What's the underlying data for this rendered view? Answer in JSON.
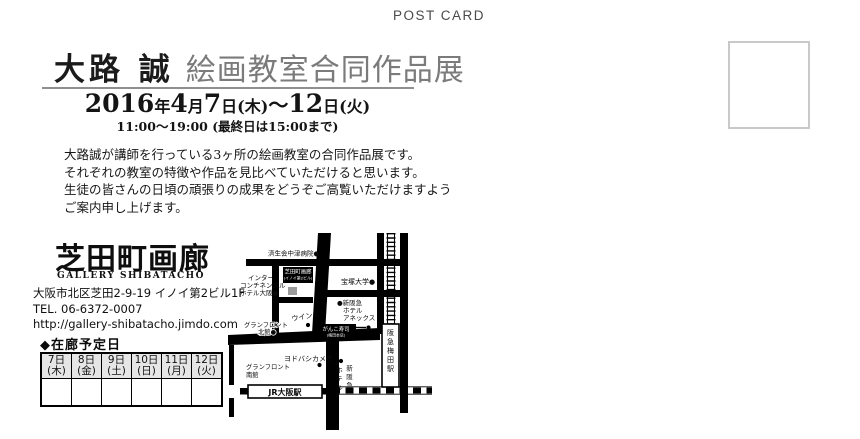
{
  "postcard_label": "POST CARD",
  "header": {
    "artist": "大路 誠",
    "exhibition": "絵画教室合同作品展",
    "date": {
      "year": "2016",
      "year_unit": "年",
      "month": "4",
      "month_unit": "月",
      "day_start": "7",
      "day_start_week": "日(木)",
      "tilde": "～",
      "day_end": "12",
      "day_end_week": "日(火)"
    },
    "time": "11:00～19:00 (最終日は15:00まで)"
  },
  "intro": {
    "lines": [
      "大路誠が講師を行っている3ヶ所の絵画教室の合同作品展です。",
      "それぞれの教室の特徴や作品を見比べていただけると思います。",
      "生徒の皆さんの日頃の頑張りの成果をどうぞご高覧いただけますよう",
      "ご案内申し上げます。"
    ]
  },
  "gallery": {
    "logo": "芝田町画廊",
    "logo_sub": "GALLERY SHIBATACHO",
    "address": "大阪市北区芝田2-9-19 イノイ第2ビル1F",
    "tel": "TEL. 06-6372-0007",
    "url": "http://gallery-shibatacho.jimdo.com"
  },
  "schedule": {
    "title": "◆在廊予定日",
    "days": [
      {
        "date": "7日",
        "weekday": "(木)"
      },
      {
        "date": "8日",
        "weekday": "(金)"
      },
      {
        "date": "9日",
        "weekday": "(土)"
      },
      {
        "date": "10日",
        "weekday": "(日)"
      },
      {
        "date": "11日",
        "weekday": "(月)"
      },
      {
        "date": "12日",
        "weekday": "(火)"
      }
    ]
  },
  "map": {
    "hospital": "済生会中津病院●",
    "intercontinental_1": "インター",
    "intercontinental_2": "コンチネンタル",
    "intercontinental_3": "ホテル大阪●",
    "gallery_label_1": "芝田町画廊",
    "gallery_label_2": "(イノイ第2ビル)",
    "takarazuka": "宝塚大学●",
    "annex_1": "●新阪急",
    "annex_2": "ホテル",
    "annex_3": "アネックス",
    "wins": "ウインズ",
    "granfront_north_1": "グランフロント",
    "granfront_north_2": "北館●",
    "ganko_1": "がんこ寿司",
    "ganko_2": "(梅田本店)",
    "yodobashi": "ヨドバシカメラ",
    "granfront_south_1": "グランフロント",
    "granfront_south_2": "南館",
    "jr_osaka": "JR大阪駅",
    "hankyu_umeda": "阪急梅田駅",
    "shin_hankyu_1": "新阪急",
    "shin_hankyu_2": "ホテル"
  },
  "colors": {
    "ink": "#141414",
    "title_gray": "#7b7b7b",
    "underline_gray": "#8f8f8f",
    "postcard_label_gray": "#4a4a4a",
    "stamp_border": "#c9c9c9",
    "table_header_bg": "#e6e6e6",
    "map_marker_gray": "#9a9a9a"
  }
}
